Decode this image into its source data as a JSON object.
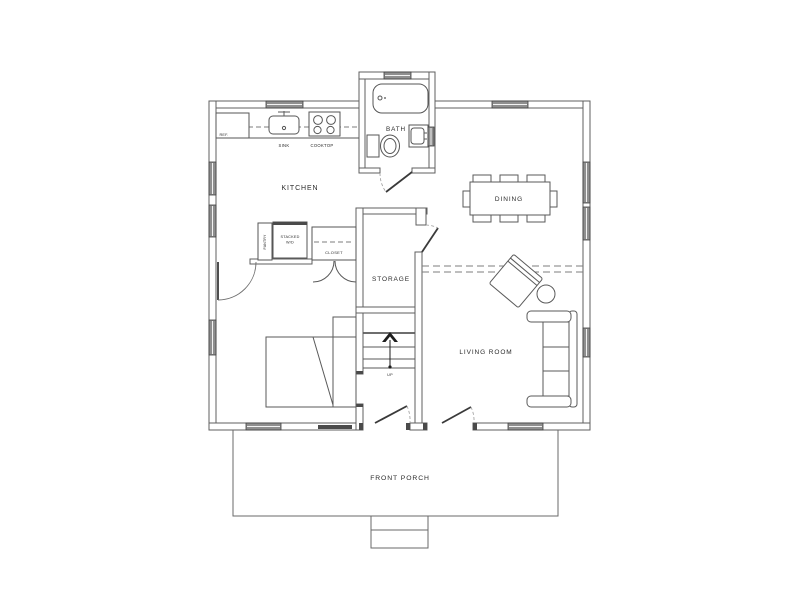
{
  "drawing": {
    "type": "residential-floor-plan",
    "rooms": [
      {
        "name": "KITCHEN"
      },
      {
        "name": "BATH"
      },
      {
        "name": "DINING"
      },
      {
        "name": "STORAGE"
      },
      {
        "name": "LIVING ROOM"
      },
      {
        "name": "FRONT PORCH"
      }
    ],
    "fixtures": [
      "refrigerator",
      "sink",
      "cooktop",
      "bathtub",
      "toilet",
      "bath-sink",
      "pantry",
      "stacked-washer-dryer",
      "closet",
      "stairs-up",
      "bed",
      "dining-table",
      "eight-chairs",
      "sofa",
      "armchair",
      "round-side-table",
      "porch-steps"
    ]
  },
  "labels": {
    "kitchen": "KITCHEN",
    "bath": "BATH",
    "dining": "DINING",
    "storage": "STORAGE",
    "living_room": "LIVING ROOM",
    "front_porch": "FRONT PORCH",
    "ref": "REF.",
    "sink": "SINK",
    "cooktop": "COOKTOP",
    "pantry": "PANTRY",
    "stacked_line1": "STACKED",
    "stacked_line2": "W/D",
    "closet": "CLOSET",
    "up": "UP"
  },
  "colors": {
    "background": "#ffffff",
    "wall_line": "#5f5f5f",
    "window_glass": "#8f8f8f",
    "door_leaf": "#3a3a3a",
    "text": "#2b2b2b"
  }
}
